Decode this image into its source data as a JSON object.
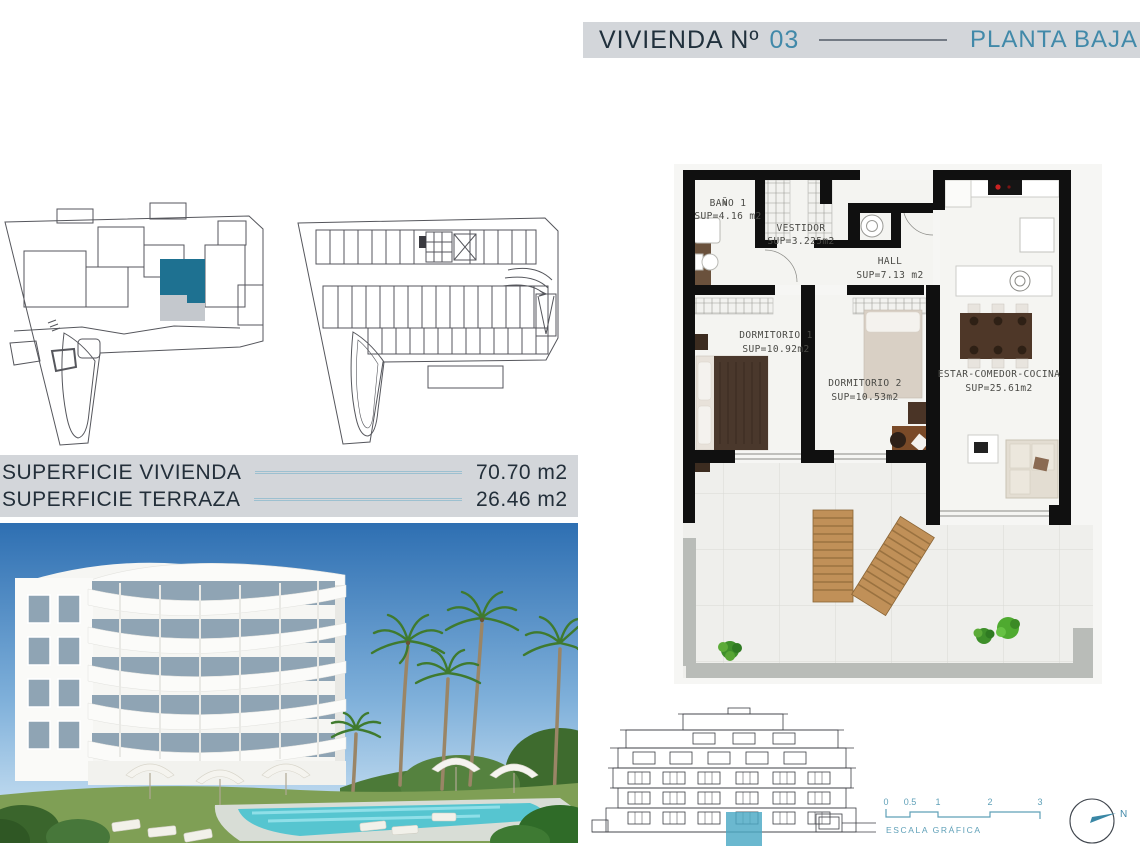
{
  "header": {
    "title": "VIVIENDA Nº",
    "unit_number": "03",
    "floor_label": "PLANTA BAJA"
  },
  "surfaces": {
    "vivienda_label": "SUPERFICIE VIVIENDA",
    "vivienda_value": "70.70 m2",
    "terraza_label": "SUPERFICIE TERRAZA",
    "terraza_value": "26.46 m2"
  },
  "floor_plan": {
    "rooms": [
      {
        "name": "BAÑO 1",
        "area": "SUP=4.16 m2"
      },
      {
        "name": "VESTIDOR",
        "area": "SUP=3.225m2"
      },
      {
        "name": "HALL",
        "area": "SUP=7.13 m2"
      },
      {
        "name": "DORMITORIO 1",
        "area": "SUP=10.92m2"
      },
      {
        "name": "DORMITORIO 2",
        "area": "SUP=10.53m2"
      },
      {
        "name": "ESTAR-COMEDOR-COCINA",
        "area": "SUP=25.61m2"
      }
    ]
  },
  "scale_bar": {
    "ticks": [
      "0",
      "0.5",
      "1",
      "2",
      "3"
    ],
    "label": "ESCALA GRÁFICA"
  },
  "compass": {
    "north_label": "N"
  },
  "colors": {
    "accent_teal": "#4189a9",
    "unit_highlight": "#1e7191",
    "header_bg": "#d3d6da",
    "dark_text": "#20303c",
    "terrace_gray": "#c4c8cd"
  }
}
